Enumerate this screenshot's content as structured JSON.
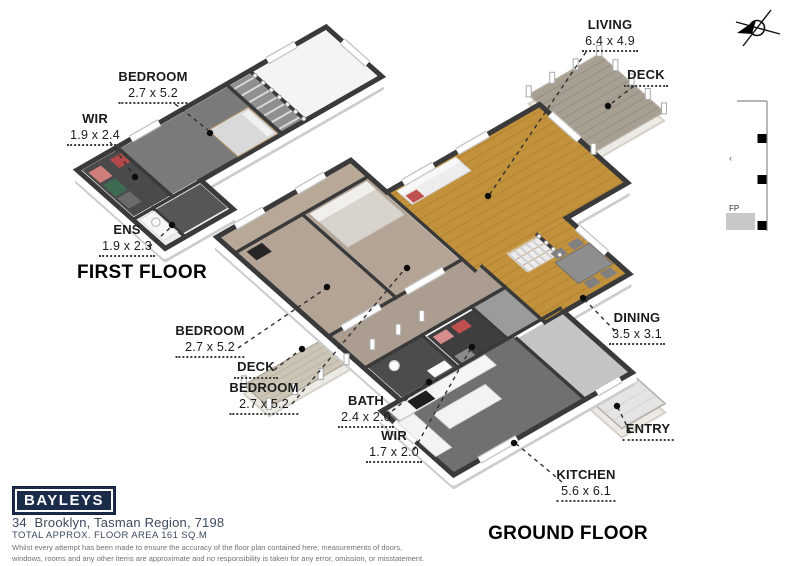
{
  "floor_titles": {
    "first": "FIRST FLOOR",
    "ground": "GROUND FLOOR"
  },
  "labels": {
    "ff_bedroom": {
      "name": "BEDROOM",
      "dims": "2.7 x 5.2"
    },
    "ff_wir": {
      "name": "WIR",
      "dims": "1.9 x 2.4"
    },
    "ff_ens": {
      "name": "ENS",
      "dims": "1.9 x 2.3"
    },
    "living": {
      "name": "LIVING",
      "dims": "6.4 x 4.9"
    },
    "deck_top": {
      "name": "DECK"
    },
    "g_bedroom1": {
      "name": "BEDROOM",
      "dims": "2.7 x 5.2"
    },
    "deck_wing": {
      "name": "DECK"
    },
    "g_bedroom2": {
      "name": "BEDROOM",
      "dims": "2.7 x 5.2"
    },
    "bath": {
      "name": "BATH",
      "dims": "2.4 x 2.0"
    },
    "g_wir": {
      "name": "WIR",
      "dims": "1.7 x 2.0"
    },
    "dining": {
      "name": "DINING",
      "dims": "3.5 x 3.1"
    },
    "entry": {
      "name": "ENTRY"
    },
    "kitchen": {
      "name": "KITCHEN",
      "dims": "5.6 x 6.1"
    }
  },
  "fp_marker": {
    "label": "FP",
    "tick": "‹"
  },
  "footer": {
    "logo_text": "BAYLEYS",
    "brand_color": "#1b2c4b",
    "address": "34  Brooklyn, Tasman Region, 7198",
    "area_line": "TOTAL APPROX. FLOOR AREA 161 SQ.M",
    "disclaimer": [
      "Whilst every attempt has been made to ensure the accuracy of the floor plan contained here, measurements of doors,",
      "windows, rooms and any other items are approximate and no responsibility is taken for any error, omission, or misstatement.",
      "This plan is for illustrative purposes only and should be used as such by any prospective purchaser."
    ]
  }
}
